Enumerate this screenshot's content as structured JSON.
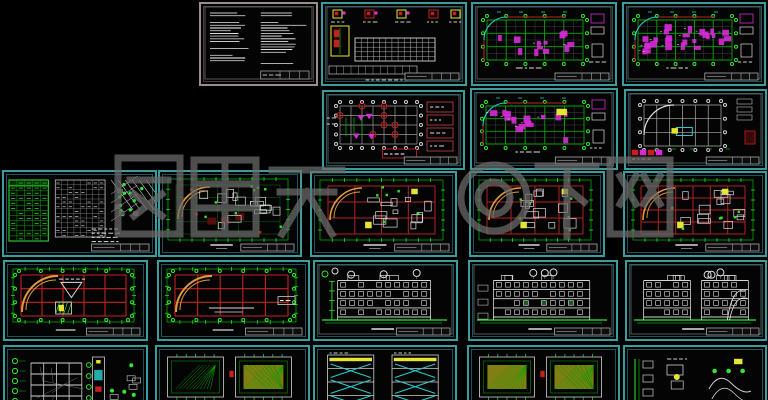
{
  "app": {
    "description": "Preview mosaic of CAD architectural drawing sheets on black background",
    "background": "#000000"
  },
  "watermark": {
    "text": "图霸天下网",
    "logo": "◎",
    "color": "#6f6f6f"
  },
  "colors": {
    "background": "#000000",
    "panel_border_teal": "#3a9c9c",
    "panel_border_gray": "#9b8d8d",
    "grid_green": "#00a800",
    "green_bright": "#2ee82e",
    "cad_red": "#c42020",
    "dark_red": "#5c1010",
    "magenta": "#d62bd6",
    "yellow": "#e6e632",
    "white_lines": "#d8d8d8",
    "gray_lines": "#9a9a9a",
    "cyan": "#2cc9c9",
    "orange_arc": "#e09a3c",
    "watermark_gray": "#6f6f6f"
  },
  "panels": [
    {
      "name": "general-notes-sheet",
      "type": "notes",
      "x": 199,
      "y": 2,
      "w": 119,
      "h": 84,
      "border": "gray",
      "seed": 11,
      "opts": {}
    },
    {
      "name": "component-details-and-schedule-sheet",
      "type": "details",
      "x": 321,
      "y": 2,
      "w": 146,
      "h": 84,
      "border": "teal",
      "seed": 22,
      "opts": {}
    },
    {
      "name": "structural-framing-plan-1",
      "type": "structm",
      "x": 471,
      "y": 2,
      "w": 146,
      "h": 84,
      "border": "teal",
      "seed": 33,
      "opts": {
        "density": 12
      }
    },
    {
      "name": "structural-framing-plan-2",
      "type": "structm",
      "x": 622,
      "y": 2,
      "w": 144,
      "h": 84,
      "border": "teal",
      "seed": 44,
      "opts": {
        "density": 26
      }
    },
    {
      "name": "foundation-plan",
      "type": "found",
      "x": 322,
      "y": 90,
      "w": 143,
      "h": 80,
      "border": "teal",
      "seed": 55,
      "opts": {}
    },
    {
      "name": "structural-framing-plan-3",
      "type": "structm",
      "x": 470,
      "y": 88,
      "w": 148,
      "h": 82,
      "border": "teal",
      "seed": 66,
      "opts": {
        "density": 15,
        "yellow": true
      }
    },
    {
      "name": "roof-framing-plan",
      "type": "roofw",
      "x": 624,
      "y": 89,
      "w": 143,
      "h": 81,
      "border": "teal",
      "seed": 77,
      "opts": {}
    },
    {
      "name": "site-plan-and-schedules",
      "type": "site",
      "x": 2,
      "y": 170,
      "w": 155,
      "h": 87,
      "border": "teal",
      "seed": 88,
      "opts": {}
    },
    {
      "name": "floor-plan-level-1",
      "type": "plangreen",
      "x": 158,
      "y": 170,
      "w": 144,
      "h": 87,
      "border": "teal",
      "seed": 99,
      "opts": {}
    },
    {
      "name": "floor-plan-level-2",
      "type": "planred",
      "x": 310,
      "y": 171,
      "w": 147,
      "h": 86,
      "border": "teal",
      "seed": 110,
      "opts": {}
    },
    {
      "name": "floor-plan-level-3",
      "type": "planred",
      "x": 469,
      "y": 171,
      "w": 136,
      "h": 86,
      "border": "teal",
      "seed": 121,
      "opts": {}
    },
    {
      "name": "floor-plan-level-4",
      "type": "planred",
      "x": 623,
      "y": 171,
      "w": 144,
      "h": 86,
      "border": "teal",
      "seed": 132,
      "opts": {
        "dense": true
      }
    },
    {
      "name": "roof-plan-1",
      "type": "roofred",
      "x": 3,
      "y": 260,
      "w": 145,
      "h": 81,
      "border": "teal",
      "seed": 143,
      "opts": {
        "variant": 1
      }
    },
    {
      "name": "roof-plan-2",
      "type": "roofred",
      "x": 157,
      "y": 260,
      "w": 153,
      "h": 81,
      "border": "teal",
      "seed": 154,
      "opts": {
        "variant": 2
      }
    },
    {
      "name": "building-elevation-1",
      "type": "elev",
      "x": 313,
      "y": 260,
      "w": 145,
      "h": 81,
      "border": "teal",
      "seed": 165,
      "opts": {
        "variant": 1
      }
    },
    {
      "name": "building-elevation-2",
      "type": "elev",
      "x": 468,
      "y": 260,
      "w": 150,
      "h": 81,
      "border": "teal",
      "seed": 176,
      "opts": {
        "variant": 2
      }
    },
    {
      "name": "building-elevation-3",
      "type": "elev",
      "x": 625,
      "y": 260,
      "w": 142,
      "h": 81,
      "border": "teal",
      "seed": 187,
      "opts": {
        "variant": 3
      }
    },
    {
      "name": "building-section-sheet",
      "type": "section",
      "x": 3,
      "y": 345,
      "w": 145,
      "h": 70,
      "border": "teal",
      "seed": 198,
      "opts": {}
    },
    {
      "name": "detail-plan-sheet-1",
      "type": "hatch",
      "x": 155,
      "y": 345,
      "w": 155,
      "h": 70,
      "border": "teal",
      "seed": 209,
      "opts": {
        "variant": 1
      }
    },
    {
      "name": "stair-section-sheet",
      "type": "stairs",
      "x": 313,
      "y": 345,
      "w": 144,
      "h": 70,
      "border": "teal",
      "seed": 220,
      "opts": {}
    },
    {
      "name": "detail-plan-sheet-2",
      "type": "hatch",
      "x": 467,
      "y": 345,
      "w": 153,
      "h": 70,
      "border": "teal",
      "seed": 231,
      "opts": {
        "variant": 2
      }
    },
    {
      "name": "misc-details-sheet",
      "type": "misc",
      "x": 623,
      "y": 345,
      "w": 144,
      "h": 70,
      "border": "teal",
      "seed": 242,
      "opts": {}
    }
  ]
}
